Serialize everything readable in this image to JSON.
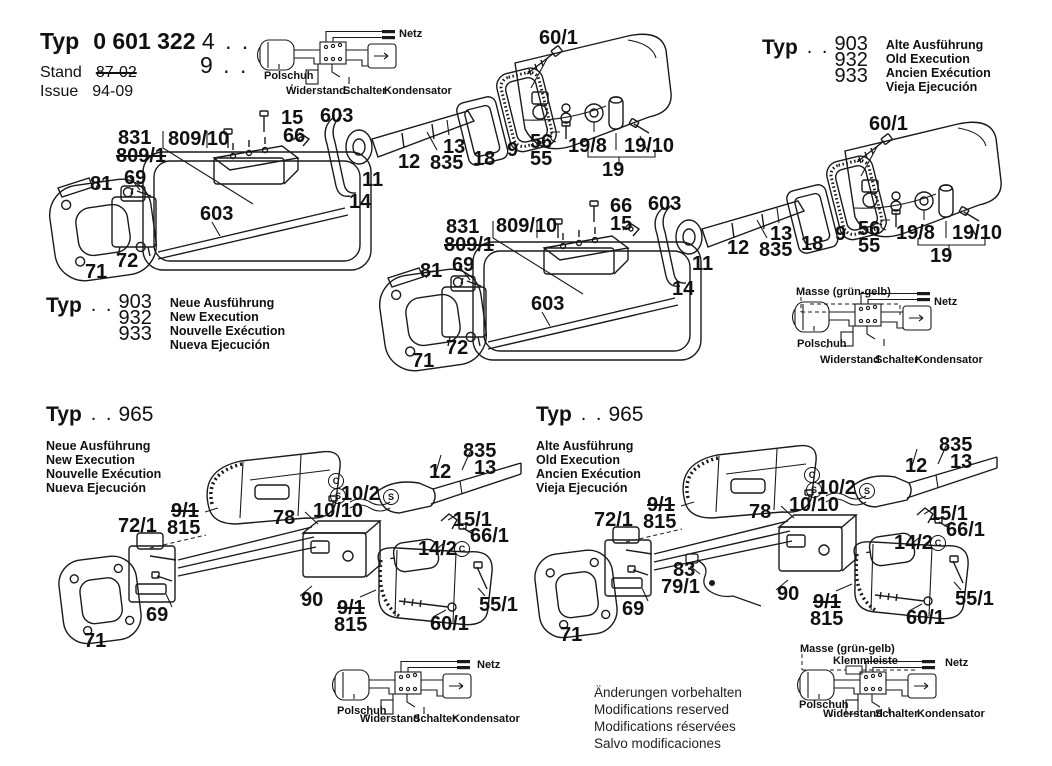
{
  "header": {
    "typ_label": "Typ",
    "code": "0 601 322",
    "code_suffix": "4 . .",
    "code_suffix2": "9 . .",
    "stand_label": "Stand",
    "stand_value": "87-02",
    "issue_label": "Issue",
    "issue_value": "94-09"
  },
  "type_blocks": [
    {
      "typ": "Typ",
      "dots": ". .",
      "nums": [
        "903",
        "932",
        "933"
      ],
      "langs": [
        "Alte Ausführung",
        "Old Execution",
        "Ancien Exécution",
        "Vieja Ejecución"
      ]
    },
    {
      "typ": "Typ",
      "dots": ". .",
      "nums": [
        "903",
        "932",
        "933"
      ],
      "langs": [
        "Neue Ausführung",
        "New Execution",
        "Nouvelle Exécution",
        "Nueva Ejecución"
      ]
    },
    {
      "typ": "Typ",
      "dots": ". .",
      "num": "965",
      "langs": [
        "Neue Ausführung",
        "New Execution",
        "Nouvelle Exécution",
        "Nueva Ejecución"
      ]
    },
    {
      "typ": "Typ",
      "dots": ". .",
      "num": "965",
      "langs": [
        "Alte Ausführung",
        "Old Execution",
        "Ancien Exécution",
        "Vieja Ejecución"
      ]
    }
  ],
  "footer": {
    "lines": [
      "Änderungen vorbehalten",
      "Modifications reserved",
      "Modifications réservées",
      "Salvo modificaciones"
    ]
  },
  "labels": [
    {
      "name": "assembly-1",
      "cls": "",
      "items": [
        {
          "t": "831",
          "x": 118,
          "y": 128
        },
        {
          "t": "809/1",
          "x": 116,
          "y": 146,
          "s": true
        },
        {
          "t": "809/10",
          "x": 168,
          "y": 129
        },
        {
          "t": "15",
          "x": 281,
          "y": 108
        },
        {
          "t": "66",
          "x": 283,
          "y": 126
        },
        {
          "t": "603",
          "x": 320,
          "y": 106
        },
        {
          "t": "81",
          "x": 90,
          "y": 174
        },
        {
          "t": "69",
          "x": 124,
          "y": 168
        },
        {
          "t": "603",
          "x": 200,
          "y": 204
        },
        {
          "t": "72",
          "x": 116,
          "y": 251
        },
        {
          "t": "71",
          "x": 85,
          "y": 262
        },
        {
          "t": "11",
          "x": 362,
          "y": 170
        },
        {
          "t": "14",
          "x": 349,
          "y": 192
        },
        {
          "t": "12",
          "x": 398,
          "y": 152
        },
        {
          "t": "13",
          "x": 443,
          "y": 137
        },
        {
          "t": "835",
          "x": 430,
          "y": 153
        },
        {
          "t": "18",
          "x": 473,
          "y": 149
        },
        {
          "t": "9",
          "x": 507,
          "y": 140
        },
        {
          "t": "56",
          "x": 530,
          "y": 132
        },
        {
          "t": "55",
          "x": 530,
          "y": 149
        },
        {
          "t": "19/8",
          "x": 568,
          "y": 136
        },
        {
          "t": "19/10",
          "x": 624,
          "y": 136
        },
        {
          "t": "19",
          "x": 602,
          "y": 160
        },
        {
          "t": "60/1",
          "x": 539,
          "y": 28
        }
      ]
    },
    {
      "name": "assembly-2",
      "cls": "",
      "items": [
        {
          "t": "66",
          "x": 610,
          "y": 196
        },
        {
          "t": "15",
          "x": 610,
          "y": 214
        },
        {
          "t": "603",
          "x": 648,
          "y": 194
        },
        {
          "t": "831",
          "x": 446,
          "y": 217
        },
        {
          "t": "809/1",
          "x": 444,
          "y": 235,
          "s": true
        },
        {
          "t": "809/10",
          "x": 496,
          "y": 216
        },
        {
          "t": "81",
          "x": 420,
          "y": 261
        },
        {
          "t": "69",
          "x": 452,
          "y": 255
        },
        {
          "t": "603",
          "x": 531,
          "y": 294
        },
        {
          "t": "72",
          "x": 446,
          "y": 338
        },
        {
          "t": "71",
          "x": 412,
          "y": 351
        },
        {
          "t": "11",
          "x": 692,
          "y": 254
        },
        {
          "t": "14",
          "x": 672,
          "y": 279
        },
        {
          "t": "12",
          "x": 727,
          "y": 238
        },
        {
          "t": "13",
          "x": 770,
          "y": 224
        },
        {
          "t": "835",
          "x": 759,
          "y": 240
        },
        {
          "t": "18",
          "x": 801,
          "y": 234
        },
        {
          "t": "9",
          "x": 835,
          "y": 224
        },
        {
          "t": "56",
          "x": 858,
          "y": 219
        },
        {
          "t": "55",
          "x": 858,
          "y": 236
        },
        {
          "t": "19/8",
          "x": 896,
          "y": 223
        },
        {
          "t": "19/10",
          "x": 952,
          "y": 223
        },
        {
          "t": "19",
          "x": 930,
          "y": 246
        },
        {
          "t": "60/1",
          "x": 869,
          "y": 114
        }
      ]
    },
    {
      "name": "assembly-3",
      "cls": "",
      "items": [
        {
          "t": "835",
          "x": 463,
          "y": 441
        },
        {
          "t": "13",
          "x": 474,
          "y": 458
        },
        {
          "t": "12",
          "x": 429,
          "y": 462
        },
        {
          "t": "C",
          "x": 328,
          "y": 473,
          "c": true
        },
        {
          "t": "S",
          "x": 330,
          "y": 488,
          "c": true
        },
        {
          "t": "10/2",
          "x": 341,
          "y": 484
        },
        {
          "t": "S",
          "x": 383,
          "y": 489,
          "c": true
        },
        {
          "t": "10/10",
          "x": 313,
          "y": 501
        },
        {
          "t": "9/1",
          "x": 171,
          "y": 501,
          "s": true
        },
        {
          "t": "815",
          "x": 167,
          "y": 518
        },
        {
          "t": "78",
          "x": 273,
          "y": 508
        },
        {
          "t": "72/1",
          "x": 118,
          "y": 516
        },
        {
          "t": "15/1",
          "x": 453,
          "y": 510
        },
        {
          "t": "66/1",
          "x": 470,
          "y": 526
        },
        {
          "t": "14/2",
          "x": 418,
          "y": 539
        },
        {
          "t": "C",
          "x": 454,
          "y": 541,
          "c": true
        },
        {
          "t": "69",
          "x": 146,
          "y": 605
        },
        {
          "t": "71",
          "x": 84,
          "y": 631
        },
        {
          "t": "90",
          "x": 301,
          "y": 590
        },
        {
          "t": "9/1",
          "x": 337,
          "y": 598,
          "s": true
        },
        {
          "t": "815",
          "x": 334,
          "y": 615
        },
        {
          "t": "60/1",
          "x": 430,
          "y": 614
        },
        {
          "t": "55/1",
          "x": 479,
          "y": 595
        }
      ]
    },
    {
      "name": "assembly-4",
      "cls": "",
      "items": [
        {
          "t": "835",
          "x": 939,
          "y": 435
        },
        {
          "t": "13",
          "x": 950,
          "y": 452
        },
        {
          "t": "12",
          "x": 905,
          "y": 456
        },
        {
          "t": "C",
          "x": 804,
          "y": 467,
          "c": true
        },
        {
          "t": "S",
          "x": 806,
          "y": 482,
          "c": true
        },
        {
          "t": "10/2",
          "x": 817,
          "y": 478
        },
        {
          "t": "S",
          "x": 859,
          "y": 483,
          "c": true
        },
        {
          "t": "10/10",
          "x": 789,
          "y": 495
        },
        {
          "t": "9/1",
          "x": 647,
          "y": 495,
          "s": true
        },
        {
          "t": "815",
          "x": 643,
          "y": 512
        },
        {
          "t": "78",
          "x": 749,
          "y": 502
        },
        {
          "t": "72/1",
          "x": 594,
          "y": 510
        },
        {
          "t": "15/1",
          "x": 929,
          "y": 504
        },
        {
          "t": "66/1",
          "x": 946,
          "y": 520
        },
        {
          "t": "14/2",
          "x": 894,
          "y": 533
        },
        {
          "t": "C",
          "x": 930,
          "y": 535,
          "c": true
        },
        {
          "t": "83",
          "x": 673,
          "y": 560
        },
        {
          "t": "79/1",
          "x": 661,
          "y": 577
        },
        {
          "t": "69",
          "x": 622,
          "y": 599
        },
        {
          "t": "71",
          "x": 560,
          "y": 625
        },
        {
          "t": "90",
          "x": 777,
          "y": 584
        },
        {
          "t": "9/1",
          "x": 813,
          "y": 592,
          "s": true
        },
        {
          "t": "815",
          "x": 810,
          "y": 609
        },
        {
          "t": "60/1",
          "x": 906,
          "y": 608
        },
        {
          "t": "55/1",
          "x": 955,
          "y": 589
        }
      ]
    },
    {
      "name": "wiring-1",
      "cls": "sm",
      "items": [
        {
          "t": "Netz",
          "x": 399,
          "y": 28
        },
        {
          "t": "Polschuh",
          "x": 264,
          "y": 70
        },
        {
          "t": "Widerstand",
          "x": 286,
          "y": 85
        },
        {
          "t": "Schalter",
          "x": 343,
          "y": 85
        },
        {
          "t": "Kondensator",
          "x": 384,
          "y": 85
        }
      ]
    },
    {
      "name": "wiring-2",
      "cls": "sm",
      "items": [
        {
          "t": "Masse (grün-gelb)",
          "x": 796,
          "y": 286
        },
        {
          "t": "Netz",
          "x": 934,
          "y": 296
        },
        {
          "t": "Polschuh",
          "x": 797,
          "y": 338
        },
        {
          "t": "Widerstand",
          "x": 820,
          "y": 354
        },
        {
          "t": "Schalter",
          "x": 875,
          "y": 354
        },
        {
          "t": "Kondensator",
          "x": 915,
          "y": 354
        }
      ]
    },
    {
      "name": "wiring-3",
      "cls": "sm",
      "items": [
        {
          "t": "Netz",
          "x": 477,
          "y": 659
        },
        {
          "t": "Polschuh",
          "x": 337,
          "y": 705
        },
        {
          "t": "Widerstand",
          "x": 360,
          "y": 713
        },
        {
          "t": "Schalter",
          "x": 413,
          "y": 713
        },
        {
          "t": "Kondensator",
          "x": 452,
          "y": 713
        }
      ]
    },
    {
      "name": "wiring-4",
      "cls": "sm",
      "items": [
        {
          "t": "Masse (grün-gelb)",
          "x": 800,
          "y": 643
        },
        {
          "t": "Klemmleiste",
          "x": 833,
          "y": 655
        },
        {
          "t": "Netz",
          "x": 945,
          "y": 657
        },
        {
          "t": "Polschuh",
          "x": 799,
          "y": 699
        },
        {
          "t": "Widerstand",
          "x": 823,
          "y": 708
        },
        {
          "t": "Schalter",
          "x": 875,
          "y": 708
        },
        {
          "t": "Kondensator",
          "x": 917,
          "y": 708
        }
      ]
    }
  ]
}
